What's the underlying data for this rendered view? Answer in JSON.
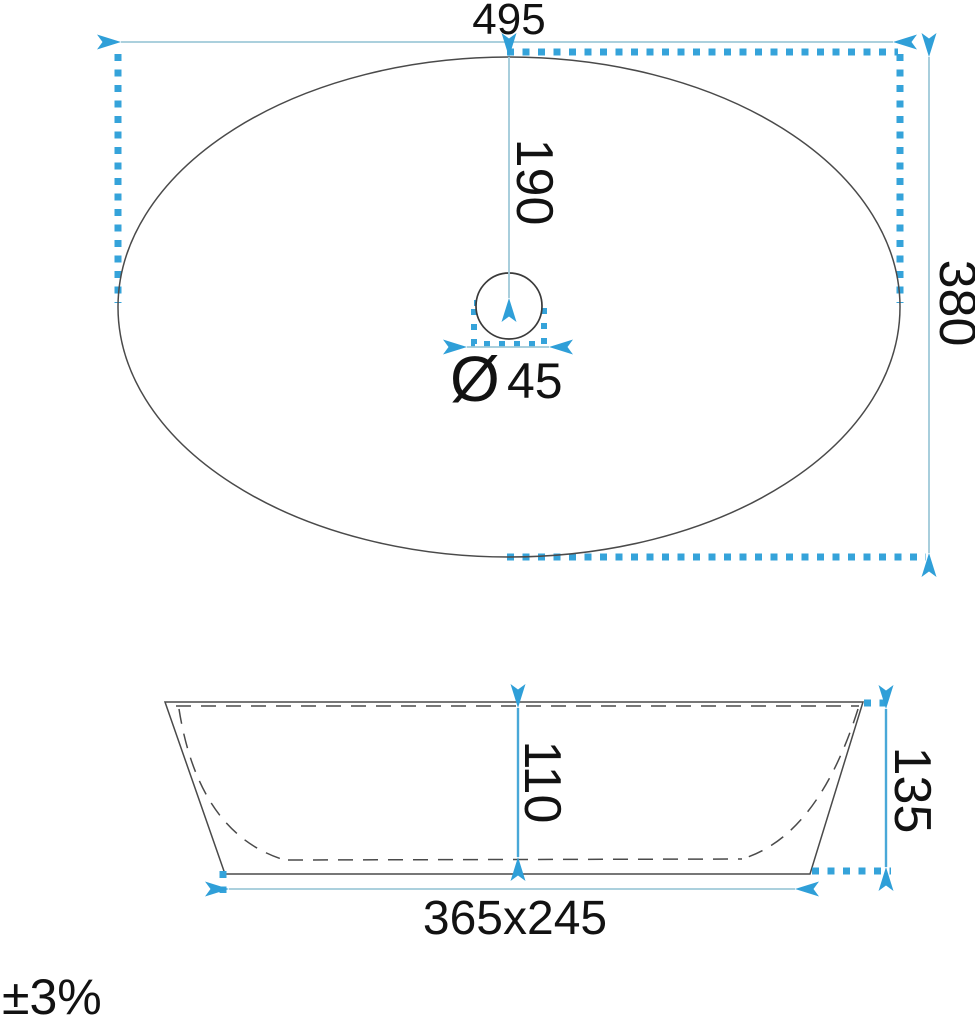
{
  "labels": {
    "top_width": "495",
    "overall_depth": "380",
    "drain_center_offset": "190",
    "drain_diameter_symbol": "Ø",
    "drain_diameter_value": "45",
    "inner_depth": "110",
    "overall_height": "135",
    "base_size": "365x245",
    "tolerance": "±3%"
  },
  "colors": {
    "dimension_accent": "#2f9fd8",
    "dimension_dots": "#35a3da",
    "dimension_line_light": "#9fc9d8",
    "dimension_line_strong": "#49a8d8",
    "outline_gray": "#4a4a4a",
    "text_black": "#121212",
    "background": "#ffffff"
  }
}
